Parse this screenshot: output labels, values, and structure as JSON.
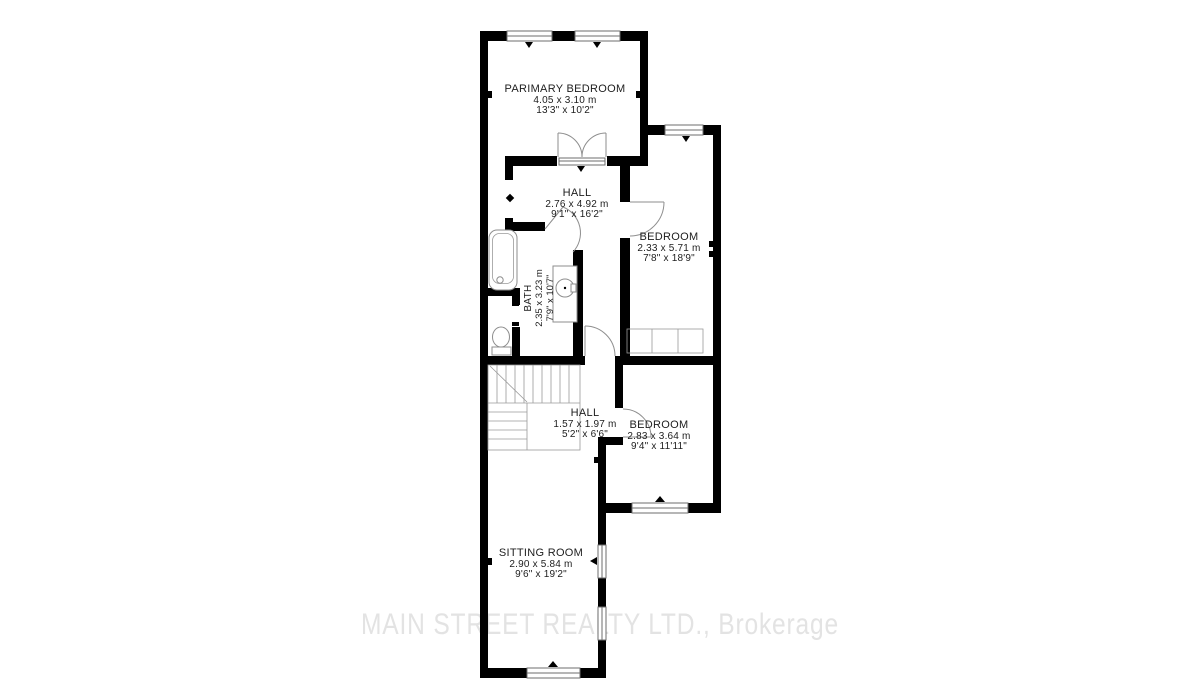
{
  "plan": {
    "colors": {
      "background": "#ffffff",
      "wall": "#000000",
      "thin_line": "#8e8e8e",
      "label_text": "#1d1d1d",
      "watermark": "#e3e3e3"
    },
    "watermark": {
      "text": "MAIN STREET REALTY LTD., Brokerage"
    },
    "rooms": [
      {
        "id": "primary-bedroom",
        "name": "PARIMARY BEDROOM",
        "metric": "4.05 x 3.10 m",
        "imperial": "13'3\" x 10'2\""
      },
      {
        "id": "hall-upper",
        "name": "HALL",
        "metric": "2.76 x 4.92 m",
        "imperial": "9'1\" x 16'2\""
      },
      {
        "id": "bedroom-right",
        "name": "BEDROOM",
        "metric": "2.33 x 5.71 m",
        "imperial": "7'8\" x 18'9\""
      },
      {
        "id": "bath",
        "name": "BATH",
        "metric": "2.35 x 3.23 m",
        "imperial": "7'9\" x 10'7\""
      },
      {
        "id": "hall-lower",
        "name": "HALL",
        "metric": "1.57 x 1.97 m",
        "imperial": "5'2\" x 6'6\""
      },
      {
        "id": "bedroom-lower",
        "name": "BEDROOM",
        "metric": "2.83 x 3.64 m",
        "imperial": "9'4\" x 11'11\""
      },
      {
        "id": "sitting-room",
        "name": "SITTING ROOM",
        "metric": "2.90 x 5.84 m",
        "imperial": "9'6\" x 19'2\""
      }
    ]
  }
}
